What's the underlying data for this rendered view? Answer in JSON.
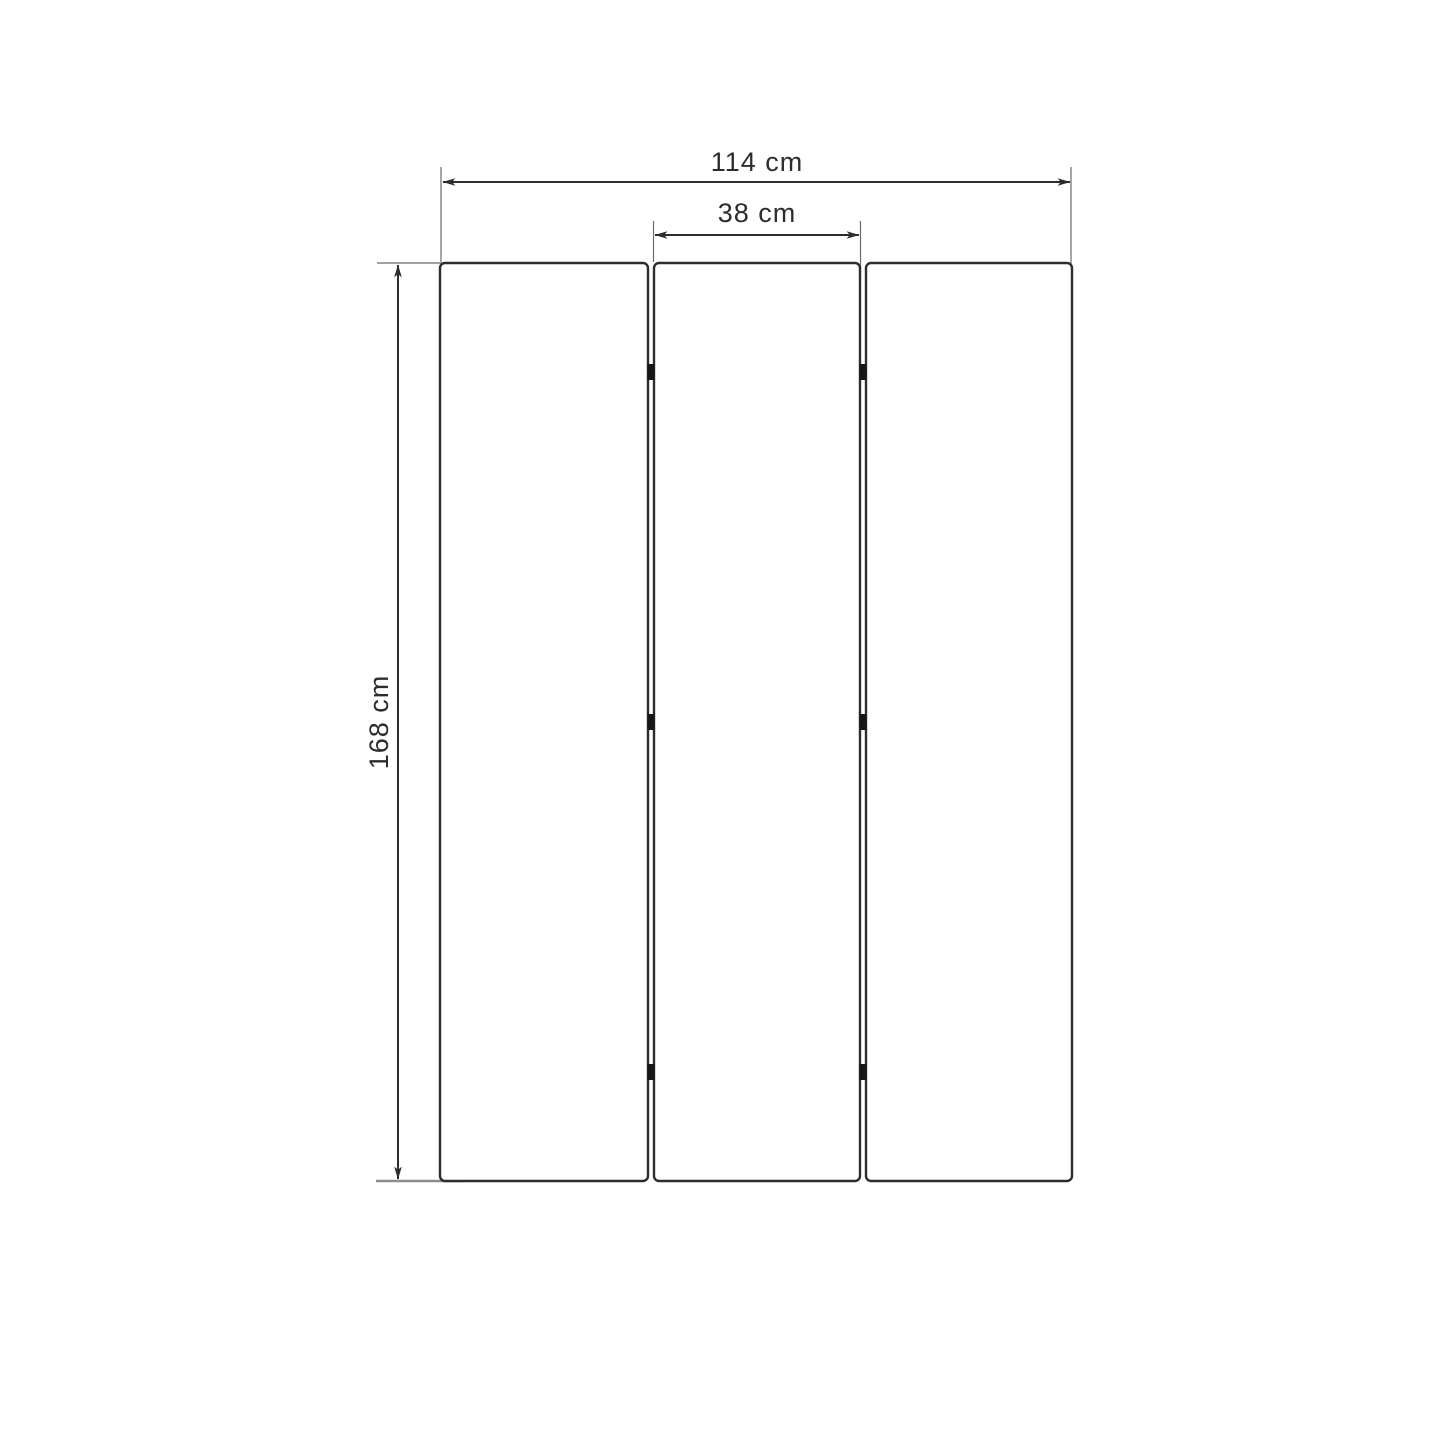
{
  "diagram": {
    "title": "three-panel-screen-dimension-drawing",
    "dimensions": {
      "total_width": {
        "label": "114 cm",
        "value": 114,
        "unit": "cm"
      },
      "panel_width": {
        "label": "38 cm",
        "value": 38,
        "unit": "cm"
      },
      "height": {
        "label": "168 cm",
        "value": 168,
        "unit": "cm"
      }
    },
    "panels": {
      "count": 3
    },
    "hinges": {
      "count": 6,
      "rows": 3
    },
    "colors": {
      "background": "#ffffff",
      "line": "#2d2d2d",
      "extension": "#6b6b6b",
      "extension_bottom": "#8c8c8c",
      "hinge": "#161616",
      "label": "#2d2d2d"
    }
  }
}
